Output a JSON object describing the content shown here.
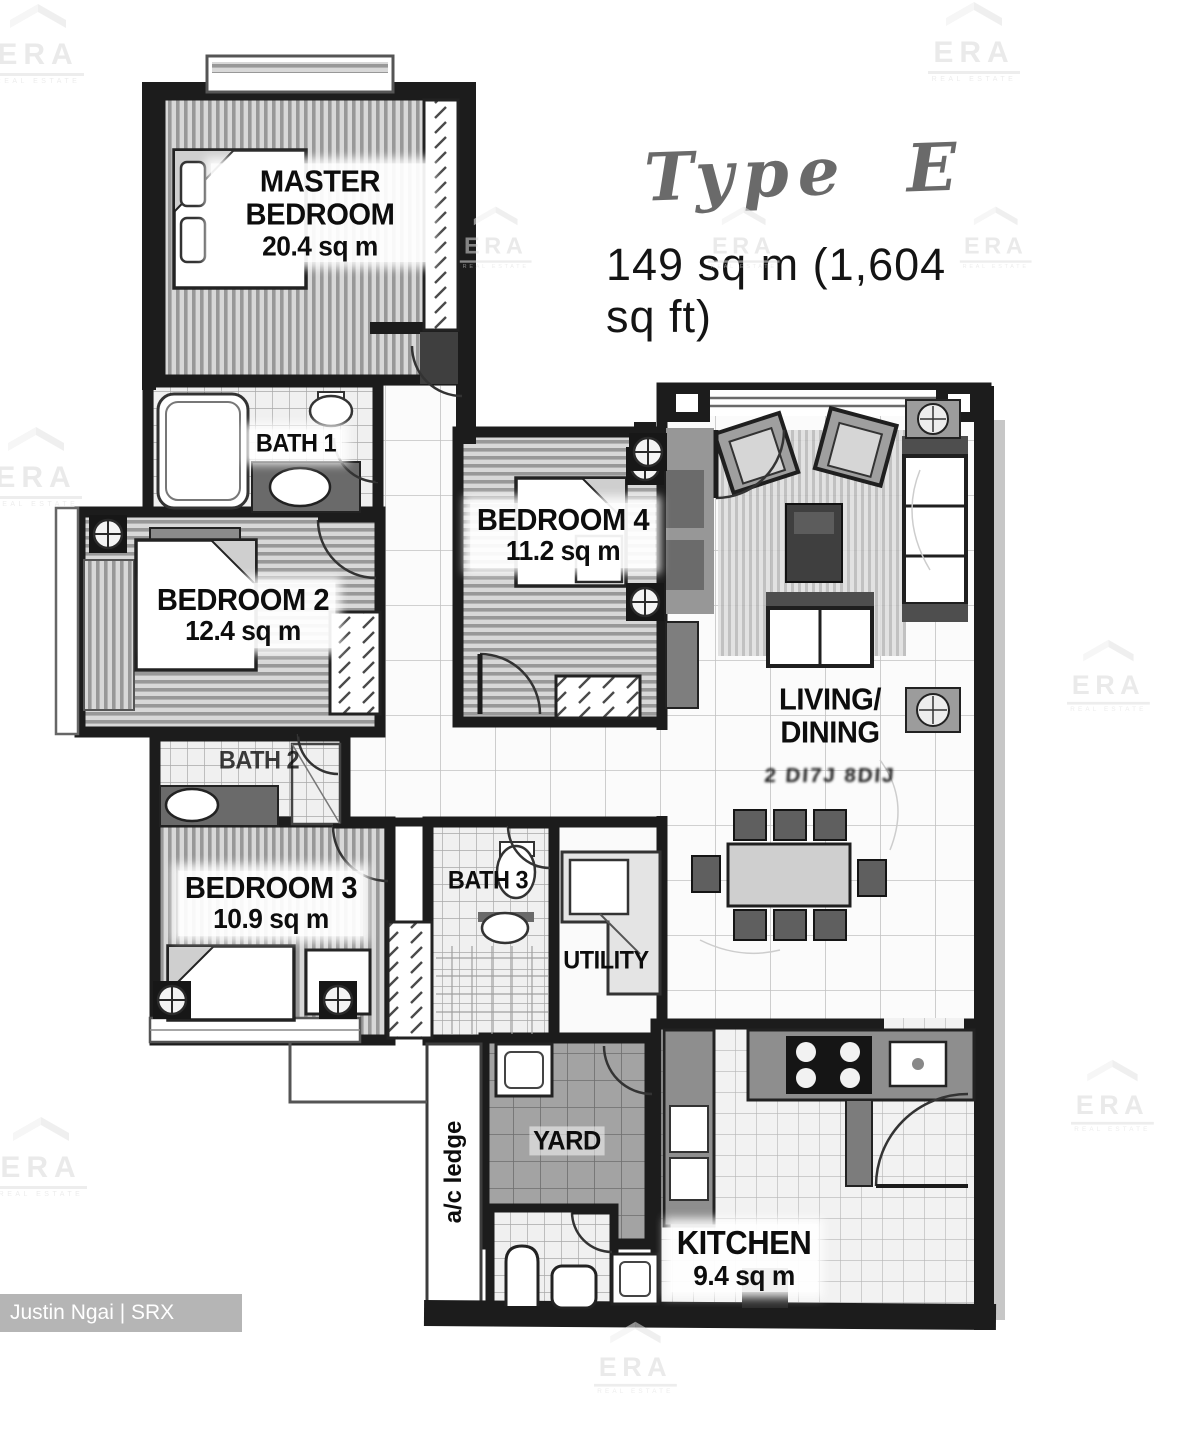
{
  "header": {
    "title": "Type E",
    "area": "149 sq m (1,604 sq ft)"
  },
  "rooms": {
    "master_bedroom": {
      "name": "MASTER BEDROOM",
      "area": "20.4 sq m"
    },
    "bath_1": {
      "name": "BATH 1"
    },
    "bedroom_2": {
      "name": "BEDROOM 2",
      "area": "12.4 sq m"
    },
    "bedroom_4": {
      "name": "BEDROOM 4",
      "area": "11.2 sq m"
    },
    "living_dining": {
      "line1": "LIVING/",
      "line2": "DINING",
      "sub": "2 DI7J 8DIJ"
    },
    "bath_2": {
      "name": "BATH 2"
    },
    "bedroom_3": {
      "name": "BEDROOM 3",
      "area": "10.9 sq m"
    },
    "bath_3": {
      "name": "BATH 3"
    },
    "utility": {
      "name": "UTILITY"
    },
    "yard": {
      "name": "YARD"
    },
    "ac_ledge": {
      "name": "a/c ledge"
    },
    "kitchen": {
      "name": "KITCHEN",
      "area": "9.4 sq m"
    }
  },
  "watermark": {
    "brand": "ERA",
    "tagline": "REAL ESTATE"
  },
  "credit": {
    "text": "Justin Ngai | SRX PROPERTY"
  },
  "colors": {
    "ink": "#1c1c1c",
    "watermark_gray": "#dedede",
    "credit_bar": "#b5b5b5"
  }
}
